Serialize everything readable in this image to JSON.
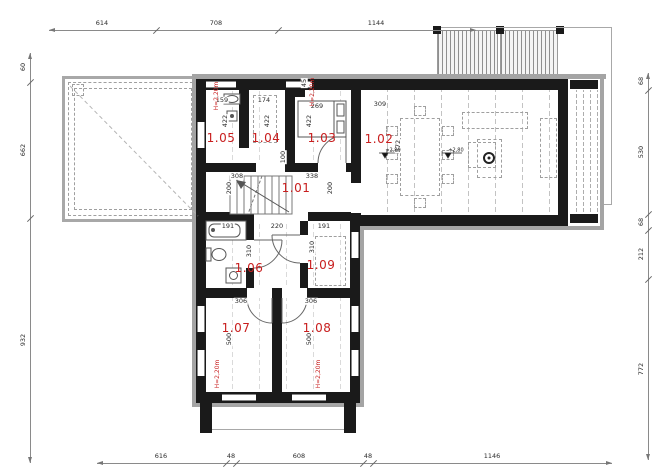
{
  "drawing_title": "floor-plan",
  "colors": {
    "wall": "#1a1a1a",
    "trim": "#a4a4a4",
    "accent_red": "#c81e1e",
    "dim_text": "#2c2c2c"
  },
  "labels": {
    "rooms": [
      {
        "id": "1-01",
        "t": "1.01",
        "x": 296,
        "y": 188
      },
      {
        "id": "1-02",
        "t": "1.02",
        "x": 379,
        "y": 139
      },
      {
        "id": "1-03",
        "t": "1.03",
        "x": 322,
        "y": 138
      },
      {
        "id": "1-04",
        "t": "1.04",
        "x": 266,
        "y": 138
      },
      {
        "id": "1-05",
        "t": "1.05",
        "x": 221,
        "y": 138
      },
      {
        "id": "1-06",
        "t": "1.06",
        "x": 249,
        "y": 268
      },
      {
        "id": "1-07",
        "t": "1.07",
        "x": 236,
        "y": 328
      },
      {
        "id": "1-08",
        "t": "1.08",
        "x": 317,
        "y": 328
      },
      {
        "id": "1-09",
        "t": "1.09",
        "x": 321,
        "y": 265
      }
    ],
    "dims": [
      {
        "t": "159",
        "x": 222,
        "y": 100
      },
      {
        "t": "174",
        "x": 264,
        "y": 100
      },
      {
        "t": "269",
        "x": 317,
        "y": 106
      },
      {
        "t": "309",
        "x": 380,
        "y": 104
      },
      {
        "t": "308",
        "x": 237,
        "y": 176
      },
      {
        "t": "338",
        "x": 312,
        "y": 176
      },
      {
        "t": "191",
        "x": 228,
        "y": 226
      },
      {
        "t": "220",
        "x": 277,
        "y": 226
      },
      {
        "t": "191",
        "x": 324,
        "y": 226
      },
      {
        "t": "306",
        "x": 241,
        "y": 301
      },
      {
        "t": "306",
        "x": 311,
        "y": 301
      },
      {
        "t": "422",
        "x": 225,
        "y": 121,
        "r": 1
      },
      {
        "t": "422",
        "x": 267,
        "y": 121,
        "r": 1
      },
      {
        "t": "422",
        "x": 309,
        "y": 121,
        "r": 1
      },
      {
        "t": "45",
        "x": 304,
        "y": 83,
        "r": 1
      },
      {
        "t": "100",
        "x": 283,
        "y": 157,
        "r": 1
      },
      {
        "t": "200",
        "x": 229,
        "y": 188,
        "r": 1
      },
      {
        "t": "200",
        "x": 330,
        "y": 188,
        "r": 1
      },
      {
        "t": "572",
        "x": 398,
        "y": 146,
        "r": 1
      },
      {
        "t": "310",
        "x": 249,
        "y": 251,
        "r": 1
      },
      {
        "t": "310",
        "x": 312,
        "y": 247,
        "r": 1
      },
      {
        "t": "500",
        "x": 229,
        "y": 339,
        "r": 1
      },
      {
        "t": "500",
        "x": 309,
        "y": 339,
        "r": 1
      }
    ],
    "heights": [
      {
        "t": "H=2,20m",
        "x": 217,
        "y": 96
      },
      {
        "t": "H=2,20m",
        "x": 313,
        "y": 92
      },
      {
        "t": "H=2,20m",
        "x": 218,
        "y": 374
      },
      {
        "t": "H=2,20m",
        "x": 319,
        "y": 374
      }
    ],
    "levels": [
      {
        "t": "+2,80",
        "x": 393,
        "y": 151
      },
      {
        "t": "+2,80",
        "x": 456,
        "y": 151
      }
    ]
  },
  "dimension_lines": {
    "top": {
      "dir": "h",
      "pos": 30,
      "from": 49,
      "to": 476,
      "ticks": [
        156,
        278
      ],
      "labels": [
        {
          "t": "614",
          "at": 102
        },
        {
          "t": "708",
          "at": 216
        },
        {
          "t": "1144",
          "at": 376
        }
      ]
    },
    "bottom": {
      "dir": "h",
      "pos": 463,
      "from": 97,
      "to": 612,
      "ticks": [
        226,
        236,
        363,
        373
      ],
      "labels": [
        {
          "t": "616",
          "at": 161
        },
        {
          "t": "48",
          "at": 231
        },
        {
          "t": "608",
          "at": 299
        },
        {
          "t": "48",
          "at": 368
        },
        {
          "t": "1146",
          "at": 492
        }
      ]
    },
    "left": {
      "dir": "v",
      "pos": 30,
      "from": 53,
      "to": 463,
      "ticks": [
        82,
        218
      ],
      "labels": [
        {
          "t": "60",
          "at": 67
        },
        {
          "t": "662",
          "at": 150
        },
        {
          "t": "932",
          "at": 340
        }
      ]
    },
    "right": {
      "dir": "v",
      "pos": 648,
      "from": 73,
      "to": 460,
      "ticks": [
        90,
        214,
        230,
        279
      ],
      "labels": [
        {
          "t": "68",
          "at": 81
        },
        {
          "t": "530",
          "at": 152
        },
        {
          "t": "68",
          "at": 222
        },
        {
          "t": "212",
          "at": 254
        },
        {
          "t": "772",
          "at": 369
        }
      ]
    }
  }
}
